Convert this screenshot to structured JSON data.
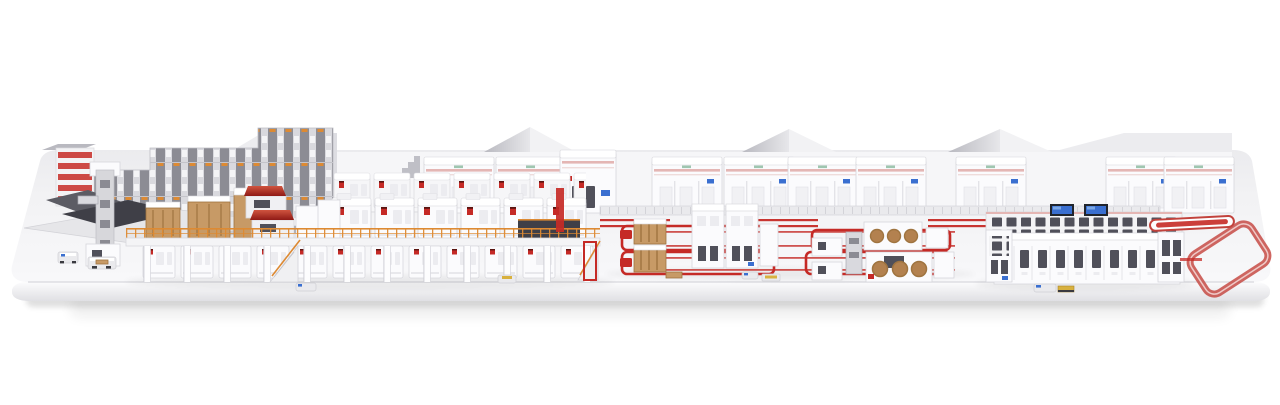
{
  "scene": {
    "description": "3D rendering of a complete corrugated board production plant standing on a long rounded white platform, viewed from the front in light perspective",
    "render_style": "photorealistic product visualization, white background, red accent conveyors",
    "palette": {
      "background": "#ffffff",
      "platform_top": "#f2f2f4",
      "platform_front_light": "#fdfdfe",
      "platform_front_dark": "#e2e2e6",
      "platform_edge": "#d8d8dd",
      "machine_white": "#fbfbfd",
      "machine_border": "#d6d6db",
      "machine_recess": "#ececf0",
      "steel_light": "#d9d9de",
      "steel_mid": "#a9a9b1",
      "steel_dark": "#76767e",
      "dark_panel": "#3f3f47",
      "accent_red": "#c52a26",
      "deep_red": "#8f1a16",
      "soft_pink": "#e4b6b4",
      "orange": "#dd8a33",
      "wood": "#c79a66",
      "wood_dark": "#9f7440",
      "copper": "#b3814f",
      "screen_blue": "#3a6fd0",
      "glass": "#50505a"
    },
    "zones": [
      {
        "id": "factory-buildings",
        "description": "white factory halls with gabled roofs along the back"
      },
      {
        "id": "background-cabinets",
        "description": "row of large white machine cabinets with thin red trim"
      },
      {
        "id": "roll-storage-rack",
        "description": "high-bay paper roll storage rack with orange rack caps"
      },
      {
        "id": "roll-handling",
        "description": "roll handling dock, splicer column and small AGV carts"
      },
      {
        "id": "corrugator-wet-end",
        "description": "wet end machines with wooden frames and red single-facer hoods on an orange-railed mezzanine"
      },
      {
        "id": "corrugator-dry-end",
        "description": "long dry-end line of white modules with red valves on two levels"
      },
      {
        "id": "floor-conveyor",
        "description": "gray transfer conveyor with double red track stripes"
      },
      {
        "id": "converting-cell-1",
        "description": "converting machines inside red floor track loops with wooden stackers and red shuttles"
      },
      {
        "id": "converting-cell-2",
        "description": "converting machines with copper reel faces inside red floor track loops"
      },
      {
        "id": "logistics-complex",
        "description": "palletizing and logistics line with dark glazing and blue control screens"
      },
      {
        "id": "shipping-loop",
        "description": "elevated red sorting conveyor ring at the platform end"
      }
    ]
  }
}
